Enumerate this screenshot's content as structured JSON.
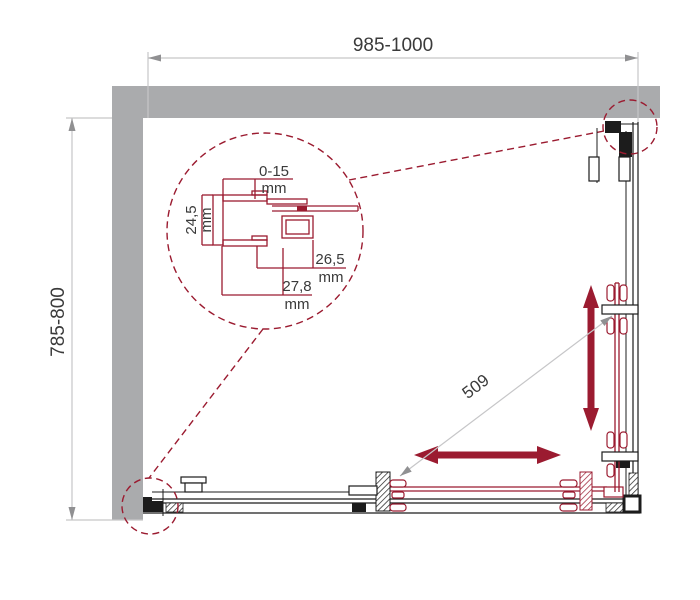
{
  "colors": {
    "wall": "#aaabad",
    "red": "#9b1b30",
    "ink": "#1c1c1c",
    "dim": "#c6c6c8",
    "dimarrow": "#909092",
    "dimtext": "#3a3a3a"
  },
  "dimensions": {
    "width": "985-1000",
    "depth": "785-800",
    "diagonal_opening": "509"
  },
  "detail": {
    "wall_gap": "0-15",
    "wall_gap_unit": "mm",
    "profile_depth": "24,5",
    "profile_depth_unit": "mm",
    "profile_inner_width": "26,5",
    "profile_inner_width_unit": "mm",
    "profile_outer_width": "27,8",
    "profile_outer_width_unit": "mm"
  }
}
